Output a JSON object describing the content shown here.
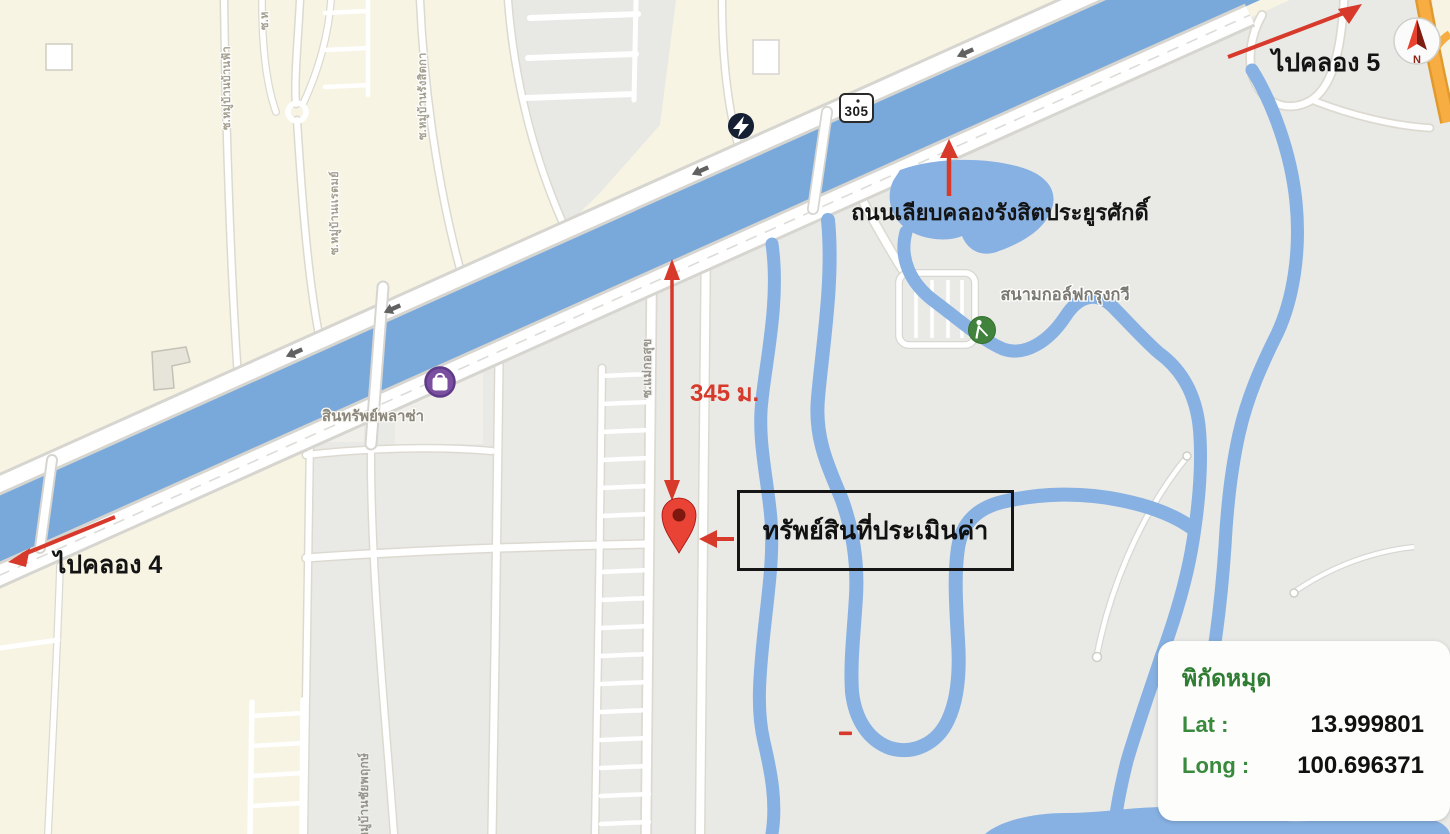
{
  "annotations": {
    "to_khlong_5": "ไปคลอง 5",
    "to_khlong_4": "ไปคลอง 4",
    "canal_road_name": "ถนนเลียบคลองรังสิตประยูรศักดิ์",
    "distance": "345 ม.",
    "property_label": "ทรัพย์สินที่ประเมินค่า"
  },
  "coordinate_card": {
    "title": "พิกัดหมุด",
    "lat_label": "Lat :",
    "lat_value": "13.999801",
    "long_label": "Long :",
    "long_value": "100.696371"
  },
  "map": {
    "route_badge": "305",
    "compass_n": "N",
    "poi": {
      "golf_course": "สนามกอล์ฟกรุงกวี",
      "plaza": "สินทรัพย์พลาซ่า"
    },
    "streets": {
      "soi_1": "ซ.หมู่บ้านบ้านฟ้า",
      "soi_2": "ซ.ห",
      "soi_3": "ซ.หมู่บ้านเเรตมย์",
      "soi_4": "ซ.หมู่บ้านรังสิตกา",
      "soi_pin": "ซ.แม่กอสุข",
      "soi_chaiyapruek": "ซ.หมู่บ้านชัยพฤกษ์"
    }
  },
  "colors": {
    "land_cream": "#f7f4e3",
    "land_gray": "#e9e9e6",
    "water_canal": "#79a8db",
    "water_golf": "#87b1e2",
    "road_white": "#ffffff",
    "annotation_red": "#d7392b",
    "pin_red": "#e94335",
    "coord_green": "#2f7d32",
    "highway_orange": "#f7ad42"
  }
}
